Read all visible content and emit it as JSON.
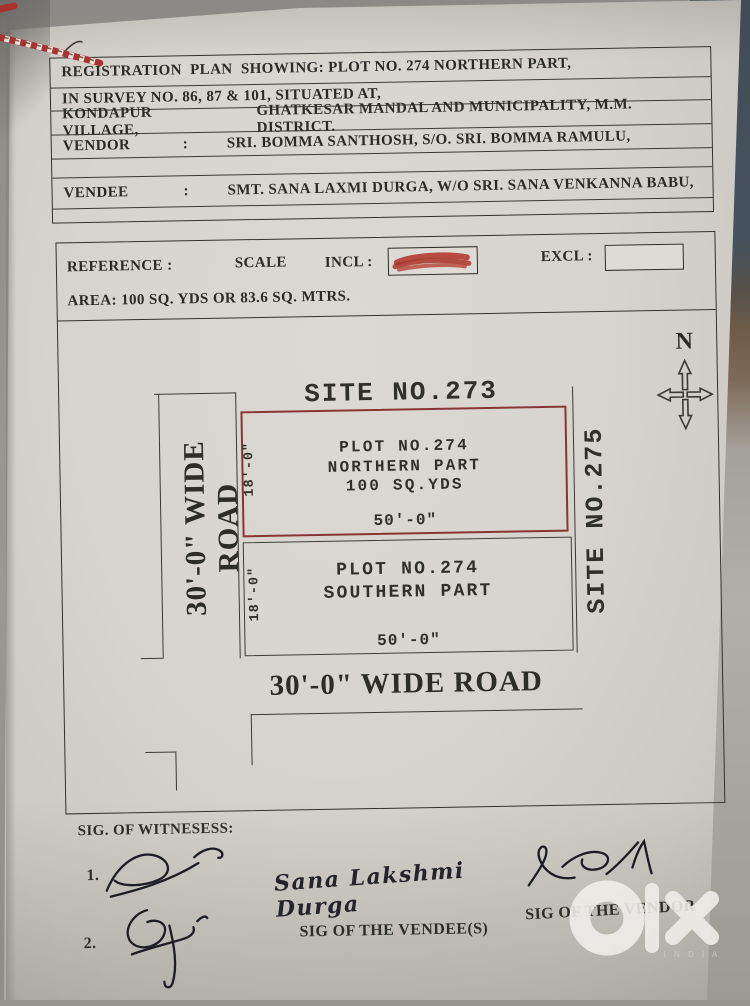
{
  "header": {
    "line1": "REGISTRATION  PLAN  SHOWING: PLOT NO. 274 NORTHERN PART,",
    "line2": "IN SURVEY NO. 86, 87 & 101, SITUATED AT,",
    "line3_label": "KONDAPUR VILLAGE,",
    "line3_rest": "GHATKESAR MANDAL AND MUNICIPALITY, M.M. DISTRICT.",
    "vendor_label": "VENDOR",
    "vendor_colon": ":",
    "vendor_value": "SRI. BOMMA SANTHOSH, S/O. SRI. BOMMA RAMULU,",
    "vendee_label": "VENDEE",
    "vendee_colon": ":",
    "vendee_value": "SMT. SANA LAXMI DURGA, W/O SRI. SANA VENKANNA BABU,"
  },
  "reference": {
    "label": "REFERENCE :",
    "scale": "SCALE",
    "incl": "INCL :",
    "excl": "EXCL :",
    "area": "AREA: 100 SQ. YDS  OR 83.6 SQ. MTRS."
  },
  "plan": {
    "north_letter": "N",
    "site_top": "SITE NO.273",
    "site_right": "SITE NO.275",
    "northern_plot": {
      "line1": "PLOT NO.274",
      "line2": "NORTHERN PART",
      "line3": "100 SQ.YDS",
      "width_dim": "50'-0\"",
      "height_dim": "18'-0\""
    },
    "southern_plot": {
      "line1": "PLOT NO.274",
      "line2": "SOUTHERN PART",
      "width_dim": "50'-0\"",
      "height_dim": "18'-0\""
    },
    "left_road": "30'-0\" WIDE ROAD",
    "bottom_road": "30'-0\" WIDE ROAD"
  },
  "footer": {
    "witnesses_heading": "SIG. OF WITNESESS:",
    "witness1_no": "1.",
    "witness2_no": "2.",
    "vendee_sig_name": "Sana Lakshmi Durga",
    "vendee_sig_label": "SIG OF THE VENDEE(S)",
    "vendor_sig_label": "SIG OF THE VENDOR"
  },
  "watermark": {
    "brand": "olx",
    "country": "I N D I A"
  },
  "colors": {
    "plot_outline_red": "#8b3434",
    "incl_scribble_red": "#b23a31",
    "paper": "#d7d4ce",
    "ink": "#2b2b26"
  }
}
